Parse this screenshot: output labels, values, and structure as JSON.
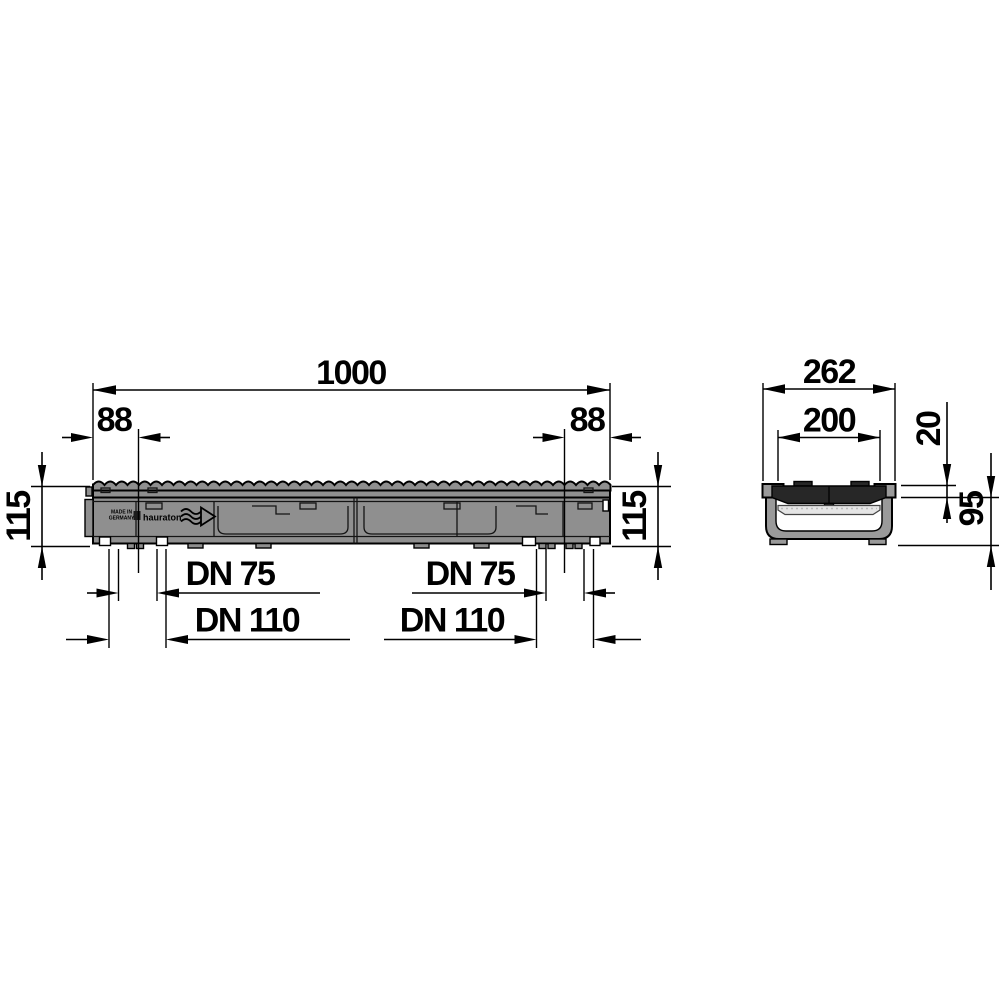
{
  "dimensions": {
    "overall_length": "1000",
    "left_outlet_offset": "88",
    "right_outlet_offset": "88",
    "height_left": "115",
    "height_right": "115",
    "outlet_small_left": "DN 75",
    "outlet_large_left": "DN 110",
    "outlet_small_right": "DN 75",
    "outlet_large_right": "DN 110",
    "overall_width": "262",
    "grate_clear_width": "200",
    "grate_depth": "20",
    "channel_body_depth": "95"
  },
  "markings": {
    "made_in_line1": "MADE IN",
    "made_in_line2": "GERMANY",
    "brand": "hauraton"
  },
  "colors": {
    "line": "#000000",
    "body_gray": "#8f8f8f",
    "section_gray": "#9a9a9a",
    "grate_dark": "#272727",
    "seal_light": "#e5e5e5",
    "background": "#ffffff"
  }
}
